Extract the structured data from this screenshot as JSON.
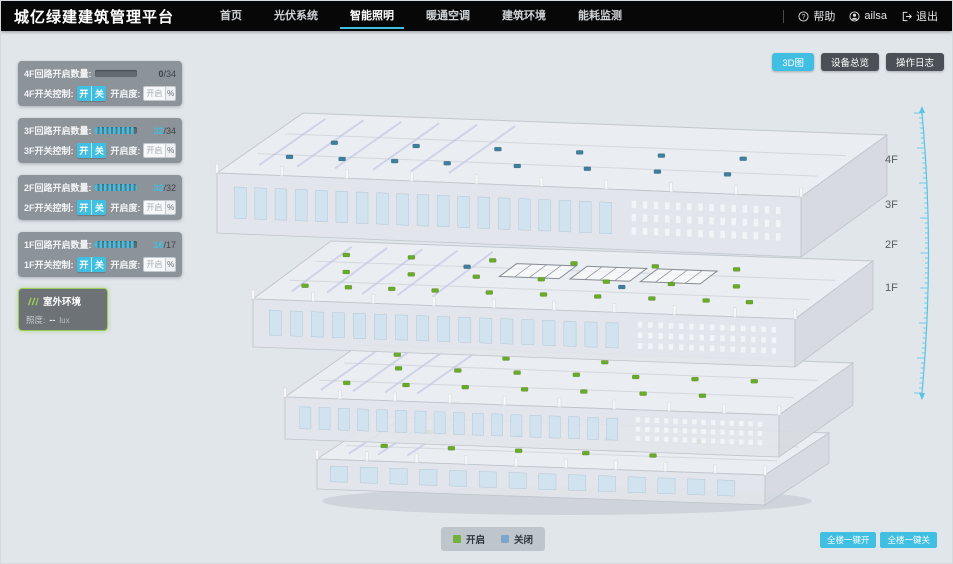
{
  "header": {
    "title": "城亿绿建建筑管理平台",
    "nav": [
      {
        "label": "首页",
        "active": false
      },
      {
        "label": "光伏系统",
        "active": false
      },
      {
        "label": "智能照明",
        "active": true
      },
      {
        "label": "暖通空调",
        "active": false
      },
      {
        "label": "建筑环境",
        "active": false
      },
      {
        "label": "能耗监测",
        "active": false
      }
    ],
    "user_area": {
      "help": "帮助",
      "username": "ailsa",
      "logout": "退出"
    }
  },
  "icons": {
    "help": "help-circle-icon",
    "user": "user-avatar-icon",
    "logout": "logout-icon",
    "outdoor": "environment-stripes-icon"
  },
  "view_buttons": [
    {
      "label": "3D图",
      "active": true
    },
    {
      "label": "设备总览",
      "active": false
    },
    {
      "label": "操作日志",
      "active": false
    }
  ],
  "floor_panels": [
    {
      "floor": "4F",
      "circuit_label": "4F回路开启数量:",
      "open": 0,
      "total": 34,
      "switch_label": "4F开关控制:",
      "on_label": "开",
      "off_label": "关",
      "dim_label": "开启度:",
      "dim_placeholder": "开启度",
      "percent_label": "%"
    },
    {
      "floor": "3F",
      "circuit_label": "3F回路开启数量:",
      "open": 32,
      "total": 34,
      "switch_label": "3F开关控制:",
      "on_label": "开",
      "off_label": "关",
      "dim_label": "开启度:",
      "dim_placeholder": "开启度",
      "percent_label": "%"
    },
    {
      "floor": "2F",
      "circuit_label": "2F回路开启数量:",
      "open": 32,
      "total": 32,
      "switch_label": "2F开关控制:",
      "on_label": "开",
      "off_label": "关",
      "dim_label": "开启度:",
      "dim_placeholder": "开启度",
      "percent_label": "%"
    },
    {
      "floor": "1F",
      "circuit_label": "1F回路开启数量:",
      "open": 16,
      "total": 17,
      "switch_label": "1F开关控制:",
      "on_label": "开",
      "off_label": "关",
      "dim_label": "开启度:",
      "dim_placeholder": "开启度",
      "percent_label": "%"
    }
  ],
  "outdoor_panel": {
    "title": "室外环境",
    "metric_label": "照度:",
    "metric_value": "--",
    "metric_unit": "lux"
  },
  "floor_labels": [
    "4F",
    "3F",
    "2F",
    "1F"
  ],
  "legend": {
    "on_label": "开启",
    "off_label": "关闭",
    "on_color": "#72b042",
    "off_color": "#7ba7cc"
  },
  "global_buttons": [
    {
      "label": "全楼一键开"
    },
    {
      "label": "全楼一键关"
    }
  ],
  "colors": {
    "accent": "#41bfe3",
    "light_on": "#67ab27",
    "light_off": "#3f7f9e",
    "ruler": "#58c4e4"
  }
}
